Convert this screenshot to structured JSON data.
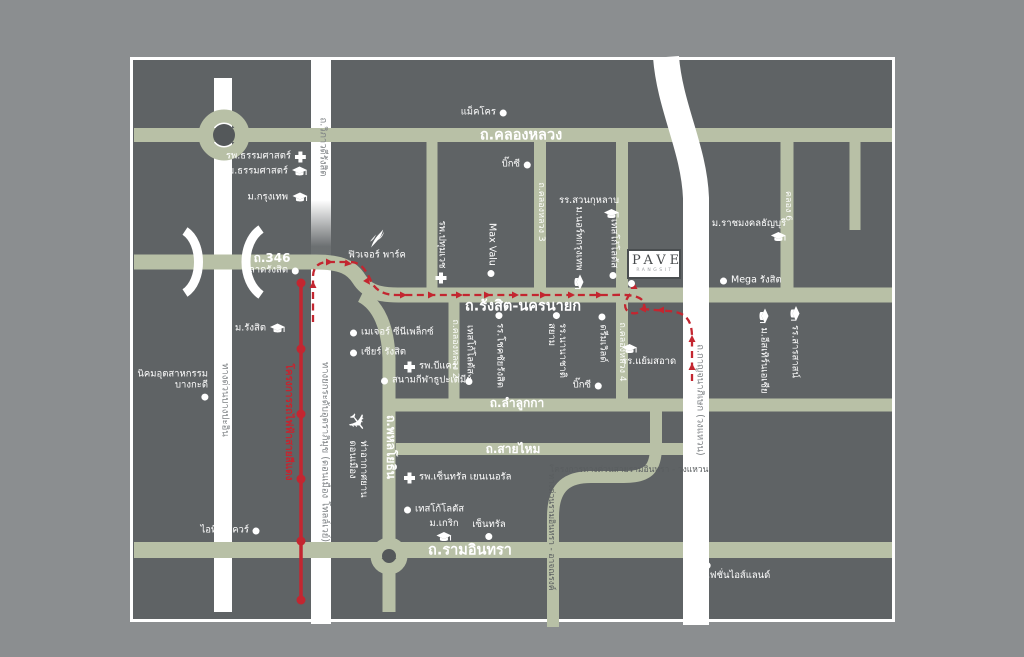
{
  "page": {
    "type": "project-location-map"
  },
  "colors": {
    "background": "#8b8e90",
    "card": "#5f6365",
    "road_green": "#b8c0a6",
    "road_white": "#ffffff",
    "route_red": "#c32630",
    "label_white": "#ffffff",
    "highway_label_gray": "#7e8285"
  },
  "pave": {
    "name": "PAVE",
    "subtitle": "RANGSIT"
  },
  "map": {
    "labels": [
      {
        "id": "road-khlong-luang",
        "t": "ถ.คลองหลวง",
        "x": 521,
        "y": 136,
        "a": "c",
        "cls": "road-lg"
      },
      {
        "id": "road-rangsit-nakhonnayok",
        "t": "ถ.รังสิต-นครนายก",
        "x": 523,
        "y": 307,
        "a": "c",
        "cls": "road-lg"
      },
      {
        "id": "road-346",
        "t": "ถ.346",
        "x": 272,
        "y": 259,
        "a": "c",
        "cls": "road-md"
      },
      {
        "id": "road-lamlukka",
        "t": "ถ.ลำลูกกา",
        "x": 517,
        "y": 404,
        "a": "c",
        "cls": "road-md"
      },
      {
        "id": "road-saimai",
        "t": "ถ.สายไหม",
        "x": 513,
        "y": 450,
        "a": "c",
        "cls": "road-md"
      },
      {
        "id": "road-ramindra",
        "t": "ถ.รามอินทรา",
        "x": 470,
        "y": 551,
        "a": "c",
        "cls": "road-lg"
      },
      {
        "id": "road-phahonyothin",
        "t": "ถ.พหลโยธิน",
        "x": 390,
        "y": 447,
        "r": 1,
        "cls": "road-md"
      },
      {
        "id": "road-khlong-luang-2",
        "t": "ถ.คลองหลวง 2",
        "x": 455,
        "y": 349,
        "r": 1,
        "cls": "road-sm"
      },
      {
        "id": "road-khlong-luang-3",
        "t": "ถ.คลองหลวง 3",
        "x": 541,
        "y": 212,
        "r": 1,
        "cls": "road-sm"
      },
      {
        "id": "road-khlong-luang-4",
        "t": "ถ.คลองหลวง 4",
        "x": 622,
        "y": 352,
        "r": 1,
        "cls": "road-sm"
      },
      {
        "id": "road-khlong-6",
        "t": "คลอง 6",
        "x": 788,
        "y": 206,
        "r": 1,
        "cls": "road-sm"
      },
      {
        "id": "road-viphavadi-rangsit",
        "t": "ถ.วิภาวดีรังสิต",
        "x": 322,
        "y": 147,
        "r": 1,
        "cls": "hwy"
      },
      {
        "id": "road-uttaraphimuk-tollway",
        "t": "ทางยกระดับอุตราภิมุข (ดอนเมือง โทลล์เวย์)",
        "x": 324,
        "y": 452,
        "r": 1,
        "cls": "hwy"
      },
      {
        "id": "road-bang-pa-in-expressway",
        "t": "ทางด่วนบางปะอิน",
        "x": 224,
        "y": 400,
        "r": 1,
        "cls": "hwy"
      },
      {
        "id": "road-kanchanaphisek",
        "t": "ถ.กาญจนาภิเษก (วงแหวน)",
        "x": 699,
        "y": 400,
        "r": 1,
        "cls": "hwy"
      },
      {
        "id": "expwy-ramindra-atnarong",
        "t": "ทางด่วนรามอินทรา - อาจณรงค์",
        "x": 550,
        "y": 532,
        "r": 1,
        "cls": "on-green"
      },
      {
        "id": "expwy-project-ramindra-wongwaen",
        "t": "โครงการทางด่วนสายรามอินทรา - วงแหวน",
        "x": 629,
        "y": 471,
        "a": "c",
        "cls": "on-green"
      },
      {
        "id": "red-line-project",
        "t": "โครงการรถไฟฟ้าสายสีแดง",
        "x": 288,
        "y": 422,
        "r": 1,
        "cls": "red-label"
      },
      {
        "id": "thammasat-hospital",
        "t": "รพ.ธรรมศาสตร์",
        "x": 306,
        "y": 157,
        "a": "r",
        "ic": "cross",
        "ip": "after"
      },
      {
        "id": "thammasat-university",
        "t": "ม.ธรรมศาสตร์",
        "x": 307,
        "y": 172,
        "a": "r",
        "ic": "cap",
        "ip": "after"
      },
      {
        "id": "bangkok-university",
        "t": "ม.กรุงเทพ",
        "x": 307,
        "y": 198,
        "a": "r",
        "ic": "cap",
        "ip": "after"
      },
      {
        "id": "makro",
        "t": "แม็คโคร",
        "x": 507,
        "y": 113,
        "a": "r",
        "ic": "dot",
        "ip": "after"
      },
      {
        "id": "big-c-khlong-luang",
        "t": "บิ๊กซี",
        "x": 531,
        "y": 165,
        "a": "r",
        "ic": "dot",
        "ip": "after"
      },
      {
        "id": "suan-kularb-school",
        "t": "รร.สวนกุหลาบ",
        "x": 589,
        "y": 208,
        "a": "c",
        "ic": "cap",
        "ip": "below",
        "ia": "end"
      },
      {
        "id": "rmut-thanyaburi",
        "t": "ม.ราชมงคลธัญบุรี",
        "x": 749,
        "y": 231,
        "a": "c",
        "ic": "cap",
        "ip": "below",
        "ia": "end"
      },
      {
        "id": "mega-rangsit",
        "t": "Mega รังสิต",
        "x": 720,
        "y": 281,
        "a": "l",
        "ic": "dot",
        "ip": "before"
      },
      {
        "id": "talad-rangsit",
        "t": "ตลาดรังสิต",
        "x": 299,
        "y": 271,
        "a": "r",
        "ic": "dot",
        "ip": "after"
      },
      {
        "id": "rangsit-university",
        "t": "ม.รังสิต",
        "x": 285,
        "y": 329,
        "a": "r",
        "ic": "cap",
        "ip": "after"
      },
      {
        "id": "bangkadi-industrial-estate",
        "t": "นิคมอุตสาหกรรม\nบางกะดี",
        "x": 208,
        "y": 385,
        "a": "r",
        "ic": "dot",
        "ip": "below",
        "ia": "end",
        "ta": "right"
      },
      {
        "id": "it-square",
        "t": "ไอที สแควร์",
        "x": 260,
        "y": 531,
        "a": "r",
        "ic": "dot",
        "ip": "after"
      },
      {
        "id": "future-park",
        "t": "ฟิวเจอร์ พาร์ค",
        "x": 377,
        "y": 245,
        "a": "c",
        "ic": "feather",
        "ip": "above"
      },
      {
        "id": "major-cineplex",
        "t": "เมเจอร์ ซีนีเพล็กซ์",
        "x": 350,
        "y": 333,
        "a": "l",
        "ic": "dot",
        "ip": "before"
      },
      {
        "id": "zeer-rangsit",
        "t": "เซียร์ รังสิต",
        "x": 350,
        "y": 353,
        "a": "l",
        "ic": "dot",
        "ip": "before"
      },
      {
        "id": "b-care-hospital",
        "t": "รพ.บีแคร์",
        "x": 404,
        "y": 367,
        "a": "l",
        "ic": "cross",
        "ip": "before"
      },
      {
        "id": "thupatemi-stadium",
        "t": "สนามกีฬาธูปะเตมีย์",
        "x": 381,
        "y": 381,
        "a": "l",
        "ic": "dot",
        "ip": "before"
      },
      {
        "id": "yaemsaard-school",
        "t": "รร.แย้มสอาด",
        "x": 622,
        "y": 356,
        "a": "l",
        "ic": "cap",
        "ip": "above",
        "ia": "start"
      },
      {
        "id": "big-c-lamlukka",
        "t": "บิ๊กซี",
        "x": 602,
        "y": 386,
        "a": "r",
        "ic": "dot",
        "ip": "after"
      },
      {
        "id": "central-general-hospital",
        "t": "รพ.เซ็นทรัล เยนเนอรัล",
        "x": 404,
        "y": 478,
        "a": "l",
        "ic": "cross",
        "ip": "before"
      },
      {
        "id": "tesco-lotus-ramindra",
        "t": "เทสโก้โลตัส",
        "x": 404,
        "y": 510,
        "a": "l",
        "ic": "dot",
        "ip": "before"
      },
      {
        "id": "krirk-university",
        "t": "ม.เกริก",
        "x": 444,
        "y": 531,
        "a": "c",
        "ic": "cap",
        "ip": "below"
      },
      {
        "id": "central-ramindra",
        "t": "เซ็นทรัล",
        "x": 489,
        "y": 530,
        "a": "c",
        "ic": "dot",
        "ip": "below"
      },
      {
        "id": "fashion-island",
        "t": "แฟชั่นไอส์แลนด์",
        "x": 737,
        "y": 572,
        "a": "c",
        "ic": "dot",
        "ip": "above",
        "ia": "start"
      },
      {
        "id": "pathum-vech-hospital",
        "t": "รพ.ปทุมเวช",
        "x": 441,
        "y": 252,
        "r": 1,
        "ic": "cross",
        "ip": "after"
      },
      {
        "id": "max-valu",
        "t": "Max Valu",
        "x": 491,
        "y": 250,
        "r": 1,
        "ic": "dot",
        "ip": "after"
      },
      {
        "id": "north-bangkok-university",
        "t": "ม.นอร์ทกรุงเทพ",
        "x": 578,
        "y": 248,
        "r": 1,
        "ic": "cap",
        "ip": "after"
      },
      {
        "id": "tesco-lotus-khlong-luang",
        "t": "เทสโก้โลตัส",
        "x": 613,
        "y": 249,
        "r": 1,
        "ic": "dot",
        "ip": "after"
      },
      {
        "id": "tesco-lotus-lamlukka",
        "t": "เทสโก้โลตัส",
        "x": 469,
        "y": 355,
        "r": 1,
        "ic": "dot",
        "ip": "after"
      },
      {
        "id": "chokchai-rangsit-school",
        "t": "รร.โชคชัยรังสิต",
        "x": 499,
        "y": 350,
        "r": 1,
        "ic": "dot",
        "ip": "before"
      },
      {
        "id": "siam-international-school",
        "t": "รร.นานาชาติ\nสยาม",
        "x": 556,
        "y": 345,
        "r": 1,
        "ic": "dot",
        "ip": "before"
      },
      {
        "id": "dream-world",
        "t": "ดรีมเวิลด์",
        "x": 602,
        "y": 338,
        "r": 1,
        "ic": "dot",
        "ip": "before"
      },
      {
        "id": "eastern-asia-university",
        "t": "ม.อีสเทิร์นเอเชีย",
        "x": 763,
        "y": 351,
        "r": 1,
        "ic": "cap",
        "ip": "before"
      },
      {
        "id": "sarasas-school",
        "t": "รร.สารสาสน์",
        "x": 794,
        "y": 342,
        "r": 1,
        "ic": "cap",
        "ip": "before"
      },
      {
        "id": "don-mueang-airport",
        "t": "ท่าอากาศยาน\nดอนเมือง",
        "x": 357,
        "y": 455,
        "r": 1,
        "ic": "plane",
        "ip": "before",
        "g": 8
      }
    ]
  }
}
